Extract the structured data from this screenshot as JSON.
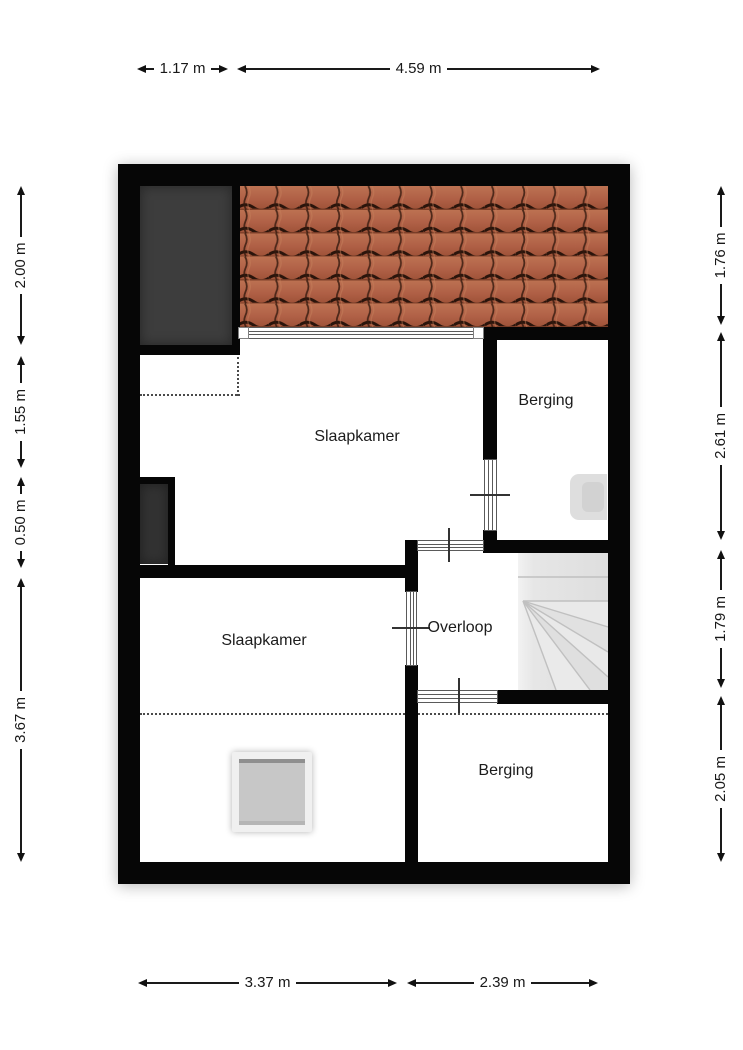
{
  "plan": {
    "type": "floorplan",
    "rooms": [
      {
        "id": "slaapkamer-top",
        "label": "Slaapkamer"
      },
      {
        "id": "berging-top",
        "label": "Berging"
      },
      {
        "id": "overloop",
        "label": "Overloop"
      },
      {
        "id": "slaapkamer-bottom",
        "label": "Slaapkamer"
      },
      {
        "id": "berging-bottom",
        "label": "Berging"
      }
    ],
    "features": [
      "roof-tiles",
      "chimney",
      "chimney-small",
      "stairs-winder",
      "skylight",
      "boiler",
      "windows",
      "doors"
    ],
    "colors": {
      "wall": "#060606",
      "roof_tile": "#b06046",
      "roof_gap": "#2a140b",
      "chimney": "#3d3d3d",
      "stairs": "#e4e4e4",
      "skylight_glass": "#c7c7c7",
      "dimension_text": "#181818"
    }
  },
  "dimensions": {
    "top": [
      {
        "label": "1.17 m"
      },
      {
        "label": "4.59 m"
      }
    ],
    "bottom": [
      {
        "label": "3.37 m"
      },
      {
        "label": "2.39 m"
      }
    ],
    "left": [
      {
        "label": "2.00 m"
      },
      {
        "label": "1.55 m"
      },
      {
        "label": "0.50 m"
      },
      {
        "label": "3.67 m"
      }
    ],
    "right": [
      {
        "label": "1.76 m"
      },
      {
        "label": "2.61 m"
      },
      {
        "label": "1.79 m"
      },
      {
        "label": "2.05 m"
      }
    ]
  }
}
